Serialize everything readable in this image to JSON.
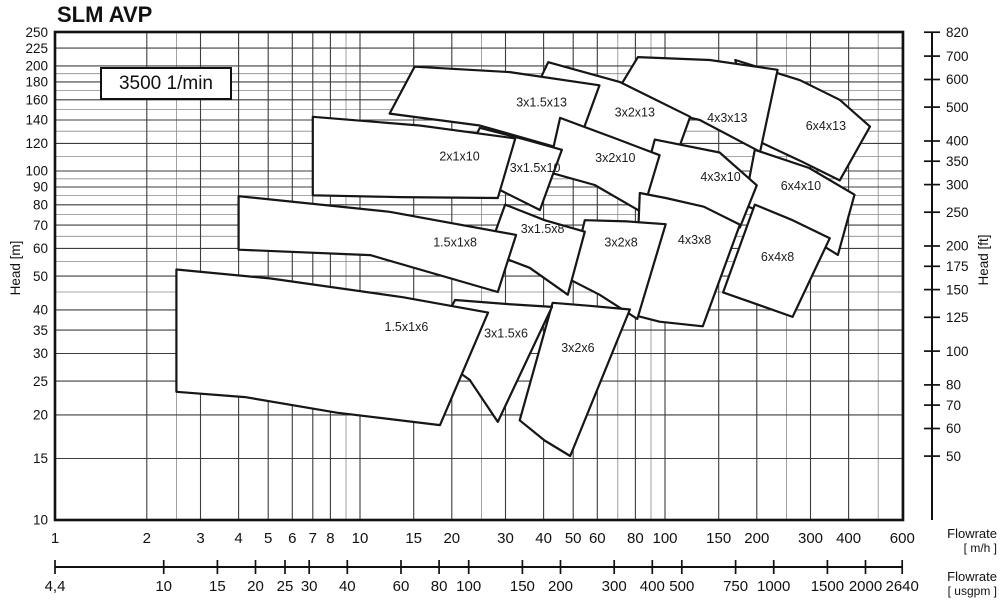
{
  "title": "SLM AVP",
  "speed_label": "3500 1/min",
  "axes": {
    "y_left": {
      "label": "Head [m]",
      "ticks": [
        250,
        225,
        200,
        180,
        160,
        140,
        120,
        100,
        90,
        80,
        70,
        60,
        50,
        40,
        35,
        30,
        25,
        20,
        15,
        10
      ]
    },
    "y_right": {
      "label": "Head [ft]",
      "ticks": [
        820,
        700,
        600,
        500,
        400,
        350,
        300,
        250,
        200,
        175,
        150,
        125,
        100,
        80,
        70,
        60,
        50
      ]
    },
    "x_mh": {
      "title": "Flowrate",
      "unit": "[ m/h ]",
      "ticks": [
        1,
        2,
        3,
        4,
        5,
        6,
        7,
        8,
        10,
        15,
        20,
        30,
        40,
        50,
        60,
        80,
        100,
        150,
        200,
        300,
        400,
        600
      ]
    },
    "x_usgpm": {
      "title": "Flowrate",
      "unit": "[ usgpm ]",
      "ticks": [
        {
          "label": "4,4",
          "value": 4.4029
        },
        {
          "label": "10",
          "value": 10
        },
        {
          "label": "15",
          "value": 15
        },
        {
          "label": "20",
          "value": 20
        },
        {
          "label": "25",
          "value": 25
        },
        {
          "label": "30",
          "value": 30
        },
        {
          "label": "40",
          "value": 40
        },
        {
          "label": "60",
          "value": 60
        },
        {
          "label": "80",
          "value": 80
        },
        {
          "label": "100",
          "value": 100
        },
        {
          "label": "150",
          "value": 150
        },
        {
          "label": "200",
          "value": 200
        },
        {
          "label": "300",
          "value": 300
        },
        {
          "label": "400",
          "value": 400
        },
        {
          "label": "500",
          "value": 500
        },
        {
          "label": "750",
          "value": 750
        },
        {
          "label": "1000",
          "value": 1000
        },
        {
          "label": "1500",
          "value": 1500
        },
        {
          "label": "2000",
          "value": 2000
        },
        {
          "label": "2640",
          "value": 2640
        }
      ]
    }
  },
  "chart_data": {
    "type": "area",
    "title": "SLM AVP",
    "subtitle": "3500 1/min",
    "x_axis": {
      "label": "Flowrate [m/h]",
      "scale": "log",
      "range": [
        1,
        600
      ]
    },
    "x_axis_secondary": {
      "label": "Flowrate [usgpm]",
      "scale": "log",
      "range": [
        4.4,
        2640
      ]
    },
    "y_axis": {
      "label": "Head [m]",
      "scale": "log",
      "range": [
        10,
        250
      ]
    },
    "y_axis_secondary": {
      "label": "Head [ft]",
      "scale": "log",
      "range": [
        50,
        820
      ]
    },
    "legend": "none",
    "grid": {
      "x_major": [
        1,
        2,
        3,
        4,
        5,
        6,
        7,
        8,
        10,
        15,
        20,
        30,
        40,
        50,
        60,
        80,
        100,
        150,
        200,
        300,
        400,
        600
      ],
      "x_minor": [
        2.5,
        9,
        25,
        70,
        90,
        250,
        500
      ],
      "y_major": [
        10,
        15,
        20,
        25,
        30,
        35,
        40,
        50,
        60,
        70,
        80,
        90,
        100,
        120,
        140,
        160,
        180,
        200,
        225,
        250
      ],
      "y_minor": [
        45,
        55,
        65,
        75,
        85,
        95,
        110,
        130,
        150,
        170,
        190
      ]
    },
    "colors": {
      "line": "#161616",
      "grid_major": "#3d3d3d",
      "grid_minor": "#8a8a8a",
      "fill": "#ffffff"
    },
    "envelopes": [
      {
        "name": "6x4x13",
        "label_at": [
          337,
          134.5
        ],
        "points": [
          [
            170,
            208
          ],
          [
            277,
            182
          ],
          [
            374,
            160
          ],
          [
            470,
            134
          ],
          [
            374,
            94
          ],
          [
            277,
            107
          ],
          [
            197,
            123
          ]
        ]
      },
      {
        "name": "4x3x13",
        "label_at": [
          160,
          142
        ],
        "points": [
          [
            81.5,
            212
          ],
          [
            140,
            208
          ],
          [
            234,
            195
          ],
          [
            205,
            113.5
          ],
          [
            130,
            140
          ],
          [
            67,
            160
          ]
        ]
      },
      {
        "name": "3x2x13",
        "label_at": [
          79.6,
          147
        ],
        "points": [
          [
            41.4,
            205
          ],
          [
            71,
            180
          ],
          [
            121,
            143
          ],
          [
            106,
            104
          ],
          [
            61,
            127
          ],
          [
            34.8,
            149
          ]
        ]
      },
      {
        "name": "3x1.5x13",
        "label_at": [
          39.4,
          157
        ],
        "points": [
          [
            15.1,
            199
          ],
          [
            31,
            192
          ],
          [
            61,
            176
          ],
          [
            50.7,
            113
          ],
          [
            24.7,
            135
          ],
          [
            12.5,
            146
          ]
        ]
      },
      {
        "name": "6x4x10",
        "label_at": [
          279,
          90.6
        ],
        "points": [
          [
            197,
            115
          ],
          [
            297,
            102
          ],
          [
            418,
            85.5
          ],
          [
            369,
            57.5
          ],
          [
            256,
            70
          ],
          [
            182,
            80
          ]
        ]
      },
      {
        "name": "4x3x10",
        "label_at": [
          152,
          96
        ],
        "points": [
          [
            92.6,
            123
          ],
          [
            151,
            113
          ],
          [
            200,
            91
          ],
          [
            176,
            68.9
          ],
          [
            121,
            75.8
          ],
          [
            82.7,
            85.5
          ]
        ]
      },
      {
        "name": "3x2x10",
        "label_at": [
          68.7,
          109
        ],
        "points": [
          [
            45.3,
            142
          ],
          [
            68.7,
            124
          ],
          [
            96,
            111
          ],
          [
            84.3,
            76
          ],
          [
            58.8,
            91.2
          ],
          [
            41.3,
            99.4
          ]
        ]
      },
      {
        "name": "3x1.5x10",
        "label_at": [
          37.5,
          102
        ],
        "points": [
          [
            24.7,
            133
          ],
          [
            34.8,
            123
          ],
          [
            45.9,
            115
          ],
          [
            38.9,
            77.3
          ],
          [
            28.7,
            88.3
          ],
          [
            20.5,
            94.2
          ]
        ]
      },
      {
        "name": "2x1x10",
        "label_at": [
          21.2,
          110
        ],
        "points": [
          [
            7,
            143
          ],
          [
            15.7,
            135
          ],
          [
            32.3,
            124
          ],
          [
            28.3,
            83.7
          ],
          [
            13.5,
            84.2
          ],
          [
            7,
            85.2
          ]
        ]
      },
      {
        "name": "4x3x8",
        "label_at": [
          125,
          63.5
        ],
        "points": [
          [
            82.7,
            86.5
          ],
          [
            100.5,
            83.7
          ],
          [
            134,
            79
          ],
          [
            176,
            70.2
          ],
          [
            133,
            35.9
          ],
          [
            96,
            37
          ],
          [
            79.6,
            38.6
          ]
        ]
      },
      {
        "name": "6x4x8",
        "label_at": [
          234,
          56.7
        ],
        "points": [
          [
            197,
            80.1
          ],
          [
            262,
            72.3
          ],
          [
            347,
            64.2
          ],
          [
            262,
            38.2
          ],
          [
            202,
            41.4
          ],
          [
            155,
            44.9
          ]
        ]
      },
      {
        "name": "3x2x8",
        "label_at": [
          71.8,
          62.3
        ],
        "points": [
          [
            54.6,
            72.3
          ],
          [
            75,
            71.7
          ],
          [
            100.5,
            70.4
          ],
          [
            81.1,
            37.7
          ],
          [
            61,
            44.2
          ],
          [
            48.9,
            48.8
          ]
        ]
      },
      {
        "name": "3x1.5x8",
        "label_at": [
          39.7,
          68.3
        ],
        "points": [
          [
            29.9,
            80.1
          ],
          [
            40.3,
            72.3
          ],
          [
            54.6,
            67
          ],
          [
            48,
            44.2
          ],
          [
            36,
            52.8
          ],
          [
            26.3,
            58.6
          ]
        ]
      },
      {
        "name": "1.5x1x8",
        "label_at": [
          20.5,
          62.3
        ],
        "points": [
          [
            4,
            84.7
          ],
          [
            12.5,
            76.4
          ],
          [
            32.5,
            65.6
          ],
          [
            28.3,
            45
          ],
          [
            10.8,
            57.4
          ],
          [
            4,
            59.5
          ]
        ]
      },
      {
        "name": "3x2x6",
        "label_at": [
          51.8,
          31.1
        ],
        "points": [
          [
            42.8,
            41.9
          ],
          [
            56.6,
            41.1
          ],
          [
            76.7,
            40.1
          ],
          [
            48.9,
            15.25
          ],
          [
            40.3,
            16.9
          ],
          [
            33.4,
            19.3
          ]
        ]
      },
      {
        "name": "3x1.5x6",
        "label_at": [
          30.1,
          34.2
        ],
        "points": [
          [
            20.5,
            42.7
          ],
          [
            29.9,
            41.6
          ],
          [
            42.6,
            40.8
          ],
          [
            28.3,
            19.1
          ],
          [
            22.9,
            25.2
          ],
          [
            16.7,
            30.7
          ]
        ]
      },
      {
        "name": "1.5x1x6",
        "label_at": [
          14.2,
          35.7
        ],
        "points": [
          [
            2.5,
            52.2
          ],
          [
            5.1,
            49.2
          ],
          [
            13.8,
            43.5
          ],
          [
            26.3,
            39.3
          ],
          [
            18.3,
            18.7
          ],
          [
            8.4,
            20.3
          ],
          [
            4.2,
            22.5
          ],
          [
            2.5,
            23.3
          ]
        ]
      }
    ]
  }
}
